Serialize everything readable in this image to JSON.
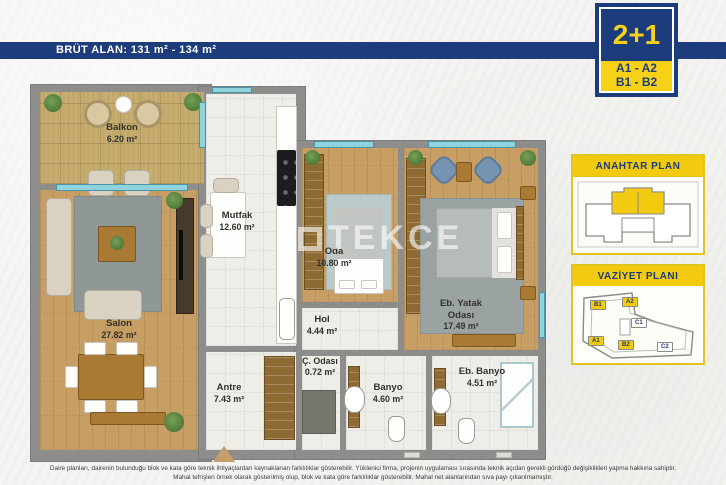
{
  "banner": {
    "label": "BRÜT ALAN: 131 m² - 134 m²"
  },
  "badge": {
    "type": "2+1",
    "line1": "A1 - A2",
    "line2": "B1 - B2"
  },
  "side_panels": {
    "key_plan_title": "ANAHTAR PLAN",
    "site_plan_title": "VAZİYET PLANI",
    "site_buildings": [
      {
        "label": "B1"
      },
      {
        "label": "A2"
      },
      {
        "label": "C1"
      },
      {
        "label": "A1"
      },
      {
        "label": "B2"
      },
      {
        "label": "C2"
      }
    ]
  },
  "floor_plan": {
    "watermark": "TEKCE",
    "rooms": [
      {
        "name": "Balkon",
        "area": "6.20 m²"
      },
      {
        "name": "Salon",
        "area": "27.82 m²"
      },
      {
        "name": "Mutfak",
        "area": "12.60 m²"
      },
      {
        "name": "Oda",
        "area": "10.80 m²"
      },
      {
        "name": "Eb. Yatak Odası",
        "area": "17.49 m²"
      },
      {
        "name": "Hol",
        "area": "4.44 m²"
      },
      {
        "name": "Antre",
        "area": "7.43 m²"
      },
      {
        "name": "Ç. Odası",
        "area": "0.72 m²"
      },
      {
        "name": "Banyo",
        "area": "4.60 m²"
      },
      {
        "name": "Eb. Banyo",
        "area": "4.51 m²"
      }
    ]
  },
  "footer": {
    "line1": "Daire planları, dairenin bulunduğu blok ve kata göre teknik ihtiyaçlardan kaynaklanan farklılıklar gösterebilir. Yüklenici firma, projenin uygulaması sırasında teknik açıdan gerekli gördüğü değişiklikleri yapma hakkına sahiptir.",
    "line2": "Mahal tefrişleri örnek olarak gösterilmiş olup, blok ve kata göre farklılıklar gösterebilir. Mahal net alanlarından sıva payı çıkarılmamıştır."
  },
  "colors": {
    "navy": "#1d3c7c",
    "yellow": "#f2ca10",
    "wall": "#8d8d8b",
    "wood": "#c79e63",
    "window": "#8fd3dd"
  }
}
